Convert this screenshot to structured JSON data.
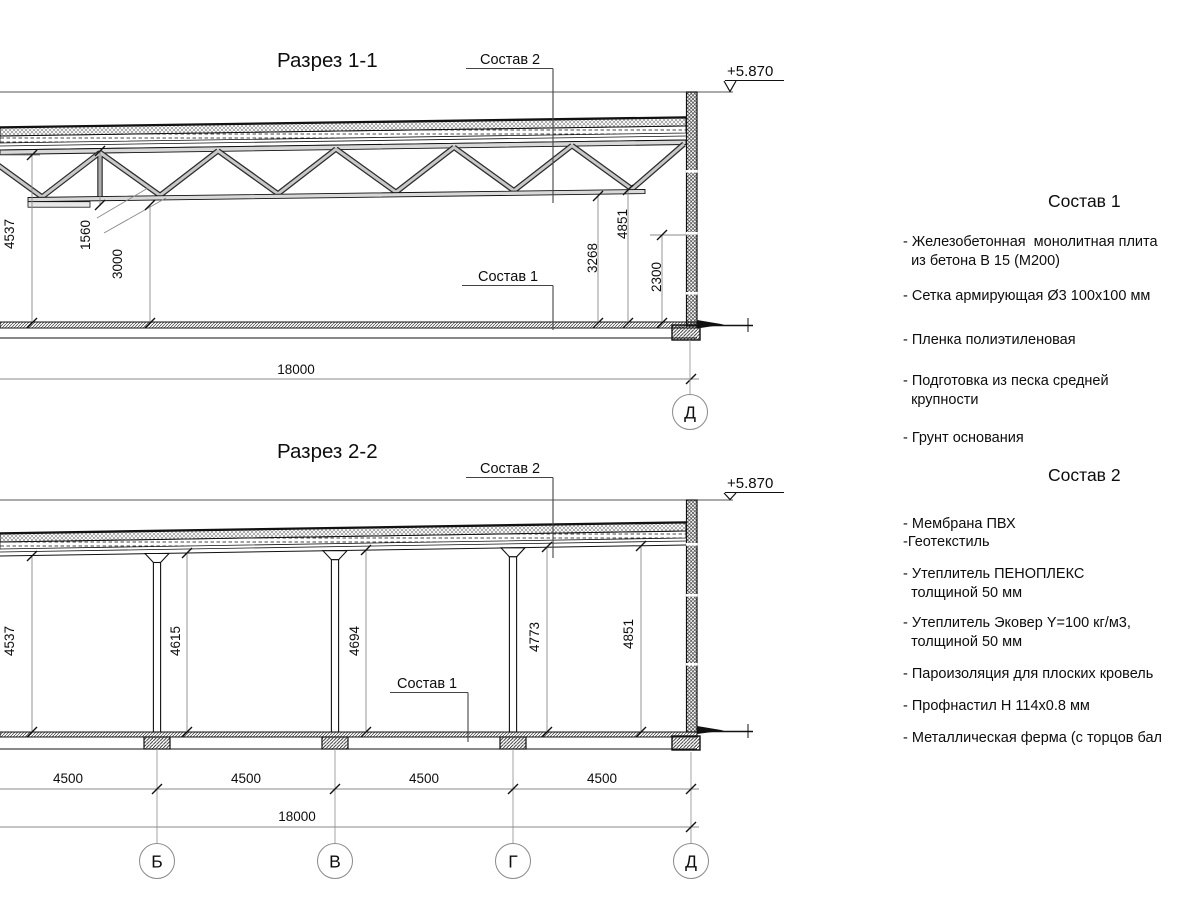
{
  "sec1": {
    "title": "Разрез 1-1",
    "label_sostav2": "Состав 2",
    "label_sostav1": "Состав 1",
    "elevation": "+5.870",
    "dim_4537": "4537",
    "dim_1560": "1560",
    "dim_3000": "3000",
    "dim_3268": "3268",
    "dim_4851": "4851",
    "dim_2300": "2300",
    "dim_span": "18000",
    "axis_d": "Д"
  },
  "sec2": {
    "title": "Разрез 2-2",
    "label_sostav2": "Состав 2",
    "label_sostav1": "Состав 1",
    "elevation": "+5.870",
    "dim_4537": "4537",
    "dim_4615": "4615",
    "dim_4694": "4694",
    "dim_4773": "4773",
    "dim_4851": "4851",
    "dim_bay1": "4500",
    "dim_bay2": "4500",
    "dim_bay3": "4500",
    "dim_bay4": "4500",
    "dim_span": "18000",
    "axes": [
      "Б",
      "В",
      "Г",
      "Д"
    ]
  },
  "panel": {
    "sostav1": {
      "title": "Состав 1",
      "items": [
        "- Железобетонная  монолитная плита\n  из бетона В 15 (М200)",
        "- Сетка армирующая Ø3 100x100 мм",
        "- Пленка полиэтиленовая",
        "- Подготовка из песка средней\n  крупности",
        "- Грунт основания"
      ]
    },
    "sostav2": {
      "title": "Состав 2",
      "items": [
        "- Мембрана ПВХ",
        "-Геотекстиль",
        "- Утеплитель ПЕНОПЛЕКС\n  толщиной 50 мм",
        "- Утеплитель Эковер Y=100 кг/м3,\n  толщиной 50 мм",
        "- Пароизоляция для плоских кровель",
        "- Профнастил Н 114x0.8 мм",
        "- Металлическая ферма (с торцов бал"
      ]
    }
  },
  "colors": {
    "line": "#111111",
    "dimline": "#8a8a8a",
    "member_fill": "#c8c8c8"
  }
}
